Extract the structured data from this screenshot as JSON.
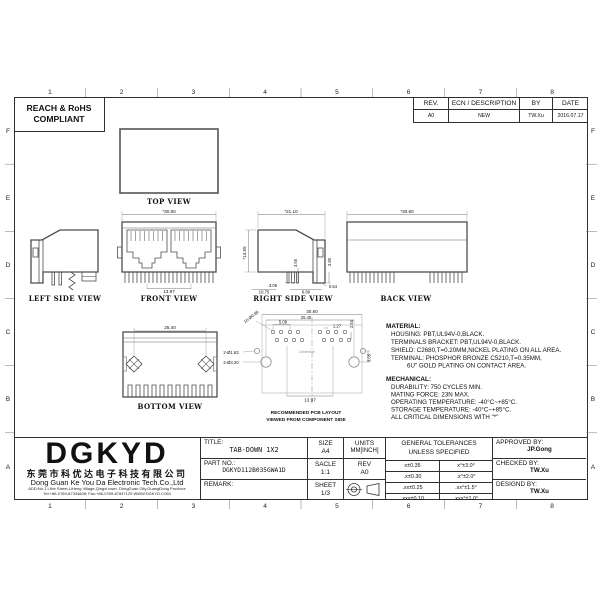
{
  "border": {
    "cols": [
      "1",
      "2",
      "3",
      "4",
      "5",
      "6",
      "7",
      "8"
    ],
    "rows": [
      "F",
      "E",
      "D",
      "C",
      "B",
      "A"
    ]
  },
  "compliance": {
    "line1": "REACH & RoHS",
    "line2": "COMPLIANT"
  },
  "revision": {
    "h_rev": "REV.",
    "h_ecn": "ECN / DESCRIPTION",
    "h_by": "BY",
    "h_date": "DATE",
    "rev": "A0",
    "ecn": "NEW",
    "by": "TW.Xu",
    "date": "2016.07.17"
  },
  "views": {
    "top": {
      "label": "TOP VIEW"
    },
    "left": {
      "label": "LEFT SIDE VIEW"
    },
    "front": {
      "label": "FRONT VIEW",
      "w": "*30.80",
      "pitch": "13.97"
    },
    "right": {
      "label": "RIGHT SIDE VIEW",
      "depth": "*21.10",
      "height": "*13.55",
      "pin_len": "3.55",
      "tab_len": "3.80",
      "pin_off": "3.05",
      "d1": "10.75",
      "d2": "6.89",
      "d3": "0.54"
    },
    "back": {
      "label": "BACK VIEW",
      "w": "*30.80"
    },
    "bottom": {
      "label": "BOTTOM VIEW",
      "pitch": "25.40"
    },
    "pcb": {
      "caption1": "RECOMMENDED PCB LAYOUT",
      "caption2": "VIEWED FROM COMPONENT SIDE",
      "centerline": "CenterLine",
      "overall": "30.60",
      "hole_pitch": "25.40",
      "pad_span": "5.08",
      "pad_pitch": "1.27",
      "row_offset": "2.54",
      "port_pitch": "13.97",
      "hole_offset": "3.05",
      "pads": "16-Ø0.89",
      "small_holes": "2-Ø1.63",
      "big_holes": "2-Ø3.20"
    }
  },
  "notes": {
    "material": {
      "title": "MATERIAL:",
      "lines": [
        "HOUSING: PBT,UL94V-0,BLACK.",
        "TERMINALS BRACKET: PBT,UL94V-0,BLACK.",
        "SHIELD: C2680,T=0.20MM,NICKEL PLATING ON ALL AREA.",
        "TERMINAL: PHOSPHOR BRONZE C5210,T=0.35MM,",
        "6U\" GOLD PLATING ON CONTACT AREA."
      ]
    },
    "mechanical": {
      "title": "MECHANICAL:",
      "lines": [
        "DURABILITY: 750 CYCLES MIN.",
        "MATING FORCE: 23N MAX.",
        "OPERATING TEMPERATURE: -40°C~+85°C.",
        "STORAGE TEMPERATURE: -40°C~+85°C.",
        "ALL CRITICAL DIMENSIONS WITH \"*\""
      ]
    }
  },
  "title_block": {
    "company": {
      "logo": "DGKYD",
      "name_cn": "东莞市科优达电子科技有限公司",
      "name_en": "Dong Guan Ke You Da Electronic Tech.Co.,Ltd",
      "address": "ADD:No.1 LiHe Street,LiHeng Village,Qingxi town, DongGuan City,GuangDong Province",
      "contact": "Tel:+86-0769-87334608; Fax:+86-0769-87847129  WWW.DGKYD.COM"
    },
    "title_label": "TITLE:",
    "title_value": "TAB-DOWN 1X2",
    "part_label": "PART NO.:",
    "part_value": "DGKYD112B035GWA1D",
    "remark_label": "REMARK:",
    "size_label": "SIZE",
    "size_value": "A4",
    "scale_label": "SACLE",
    "scale_value": "1:1",
    "sheet_label": "SHEET",
    "sheet_value": "1/3",
    "units_label": "UNITS",
    "units_value": "MM[INCH]",
    "rev_label": "REV",
    "rev_value": "A0",
    "tolerances": {
      "header1": "GENERAL TOLERANCES",
      "header2": "UNLESS SPECIFIED",
      "rows": [
        [
          "x±0.35",
          "x°±3.0°"
        ],
        [
          ".x±0.30",
          ".x°±2.0°"
        ],
        [
          ".xx±0.25",
          ".xx°±1.5°"
        ],
        [
          ".xxx±0.10",
          ".xxx°±1.0°"
        ]
      ]
    },
    "approved_label": "APPROVED BY:",
    "approved_value": "JP.Gong",
    "checked_label": "CHECKED BY:",
    "checked_value": "TW.Xu",
    "designed_label": "DESIGND BY:",
    "designed_value": "TW.Xu"
  }
}
